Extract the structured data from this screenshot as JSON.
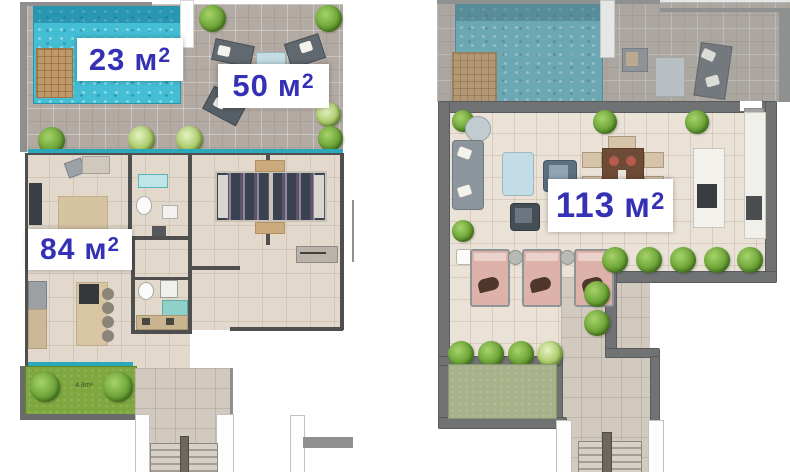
{
  "labels": {
    "pool": {
      "value": "23",
      "unit": "м",
      "sup": "2"
    },
    "terrace": {
      "value": "50",
      "unit": "м",
      "sup": "2"
    },
    "apartment": {
      "value": "84",
      "unit": "м",
      "sup": "2"
    },
    "penthouse": {
      "value": "113",
      "unit": "м",
      "sup": "2"
    }
  },
  "garden": {
    "note": "4.8m²"
  },
  "palette": {
    "label_text": "#3431b4",
    "label_bg": "#ffffff",
    "pool_water": "#43bed4",
    "deck_wood": "#bf9768",
    "lawn_bright": "#7ea73f",
    "lawn_muted": "#a7b28a",
    "bush_green": "#6ba336",
    "wall_dark": "#4f4f4f",
    "wall_thick": "#707274",
    "lounger_pink": "#ddb2a9",
    "terrace_tile": "#b3aba3",
    "interior_tile": "#e2d9cc"
  }
}
